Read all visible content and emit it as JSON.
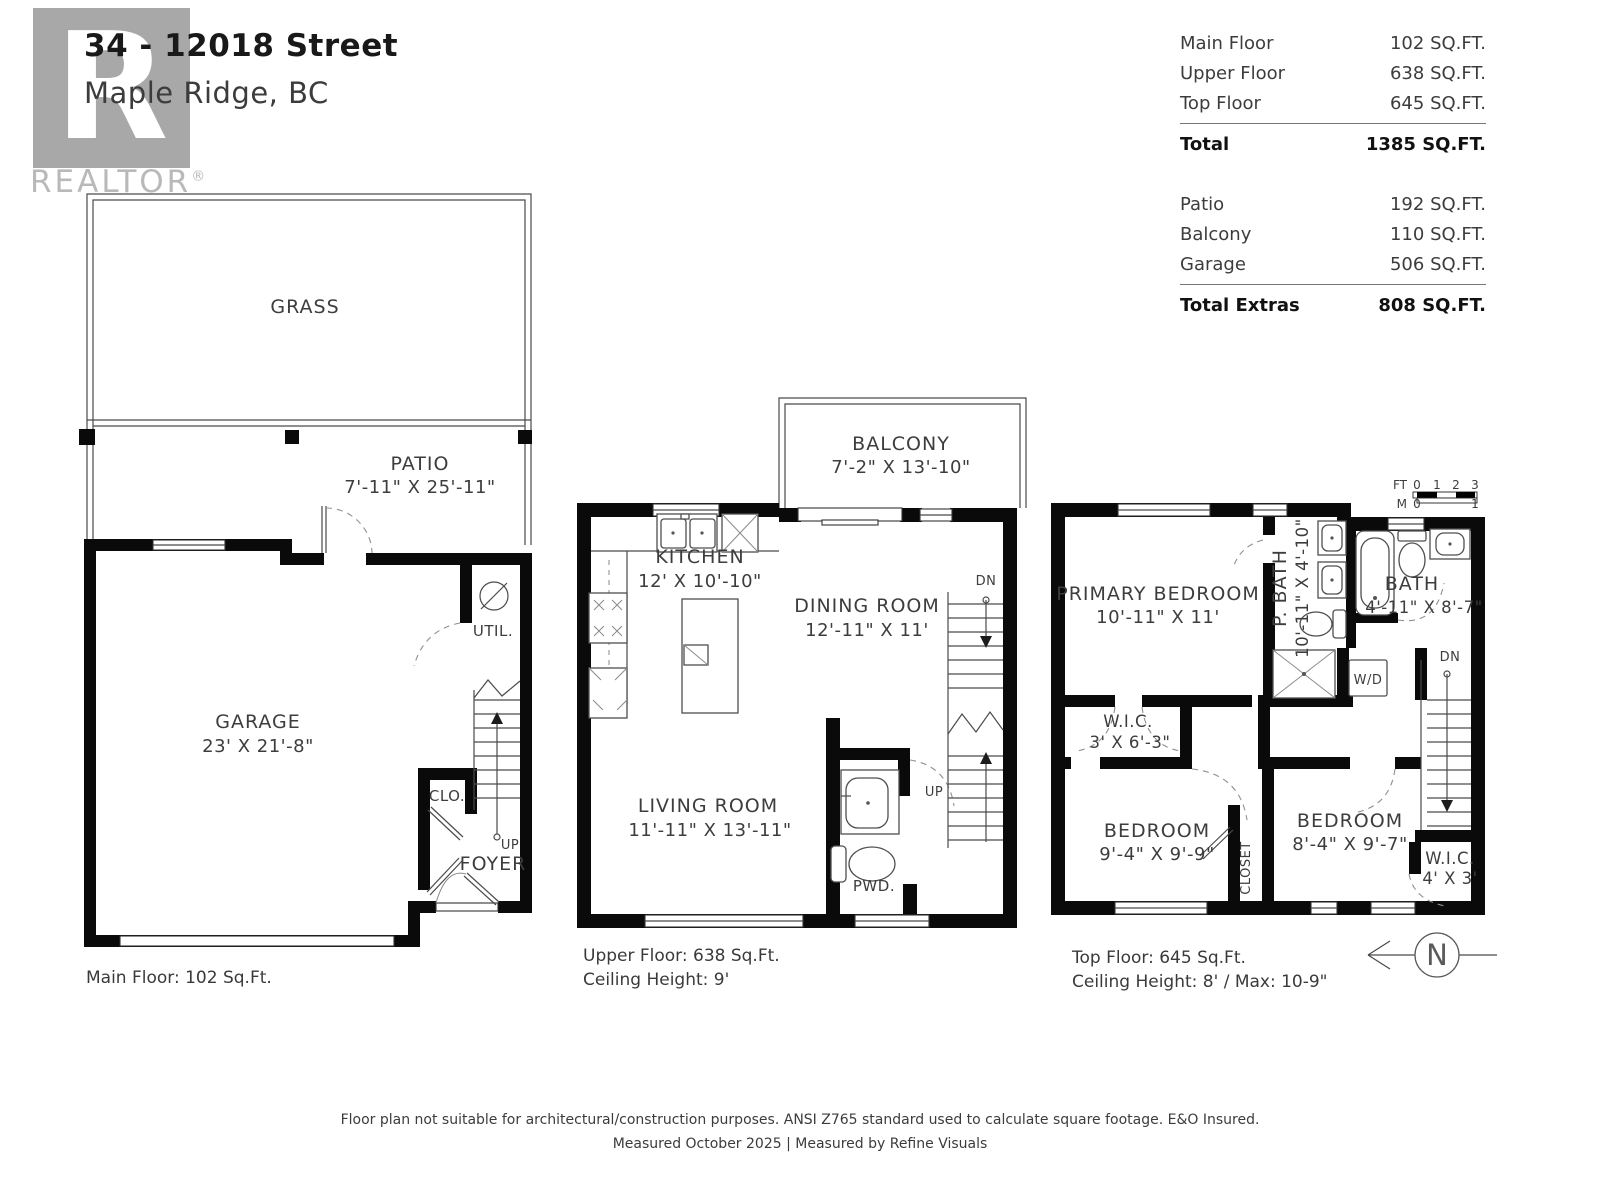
{
  "header": {
    "title": "34 - 12018 Street",
    "subtitle": "Maple Ridge, BC",
    "logo": {
      "letter": "R",
      "word": "REALTOR",
      "registered": "®"
    }
  },
  "area_summary": {
    "rows": [
      {
        "label": "Main Floor",
        "value": "102 SQ.FT."
      },
      {
        "label": "Upper Floor",
        "value": "638 SQ.FT."
      },
      {
        "label": "Top Floor",
        "value": "645 SQ.FT."
      },
      {
        "label": "Total",
        "value": "1385 SQ.FT."
      },
      {
        "label": "Patio",
        "value": "192 SQ.FT."
      },
      {
        "label": "Balcony",
        "value": "110 SQ.FT."
      },
      {
        "label": "Garage",
        "value": "506 SQ.FT."
      },
      {
        "label": "Total Extras",
        "value": "808 SQ.FT."
      }
    ]
  },
  "plans": {
    "main": {
      "caption": "Main Floor: 102 Sq.Ft.",
      "labels": {
        "grass": "GRASS",
        "patio_name": "PATIO",
        "patio_dims": "7'-11\" X 25'-11\"",
        "garage_name": "GARAGE",
        "garage_dims": "23' X 21'-8\"",
        "util": "UTIL.",
        "clo": "CLO.",
        "foyer": "FOYER",
        "up": "UP"
      }
    },
    "upper": {
      "caption_area": "Upper Floor: 638 Sq.Ft.",
      "caption_ceiling": "Ceiling Height: 9'",
      "labels": {
        "balcony_name": "BALCONY",
        "balcony_dims": "7'-2\" X 13'-10\"",
        "kitchen_name": "KITCHEN",
        "kitchen_dims": "12' X 10'-10\"",
        "dining_name": "DINING ROOM",
        "dining_dims": "12'-11\" X 11'",
        "living_name": "LIVING ROOM",
        "living_dims": "11'-11\" X 13'-11\"",
        "pwd": "PWD.",
        "up": "UP",
        "dn": "DN"
      }
    },
    "top": {
      "caption_area": "Top Floor: 645 Sq.Ft.",
      "caption_ceiling": "Ceiling Height: 8' / Max: 10-9\"",
      "labels": {
        "primary_name": "PRIMARY BEDROOM",
        "primary_dims": "10'-11\" X 11'",
        "pbath_name": "P. BATH",
        "pbath_dims": "10'-11\" X 4'-10\"",
        "bath_name": "BATH",
        "bath_dims": "4'-11\" X 8'-7\"",
        "wd": "W/D",
        "wic1_name": "W.I.C.",
        "wic1_dims": "3' X 6'-3\"",
        "bedroom1_name": "BEDROOM",
        "bedroom1_dims": "9'-4\" X 9'-9\"",
        "closet": "CLOSET",
        "bedroom2_name": "BEDROOM",
        "bedroom2_dims": "8'-4\" X 9'-7\"",
        "wic2_name": "W.I.C.",
        "wic2_dims": "4' X 3'",
        "dn": "DN"
      }
    }
  },
  "scale_bar": {
    "ft_label": "FT",
    "ft_ticks": [
      "0",
      "1",
      "2",
      "3"
    ],
    "m_label": "M",
    "m_ticks": [
      "0",
      "1"
    ]
  },
  "compass": {
    "north": "N"
  },
  "footer": {
    "line1": "Floor plan not suitable for architectural/construction purposes. ANSI Z765 standard used to calculate square footage. E&O Insured.",
    "line2": "Measured October 2025 | Measured by Refine Visuals"
  },
  "colors": {
    "wall": "#0a0a0a",
    "label_text": "#3d3d3d",
    "logo_gray": "#a8a8a8",
    "wordmark_gray": "#b9b9b9",
    "thin_line": "#4a4a4a"
  }
}
